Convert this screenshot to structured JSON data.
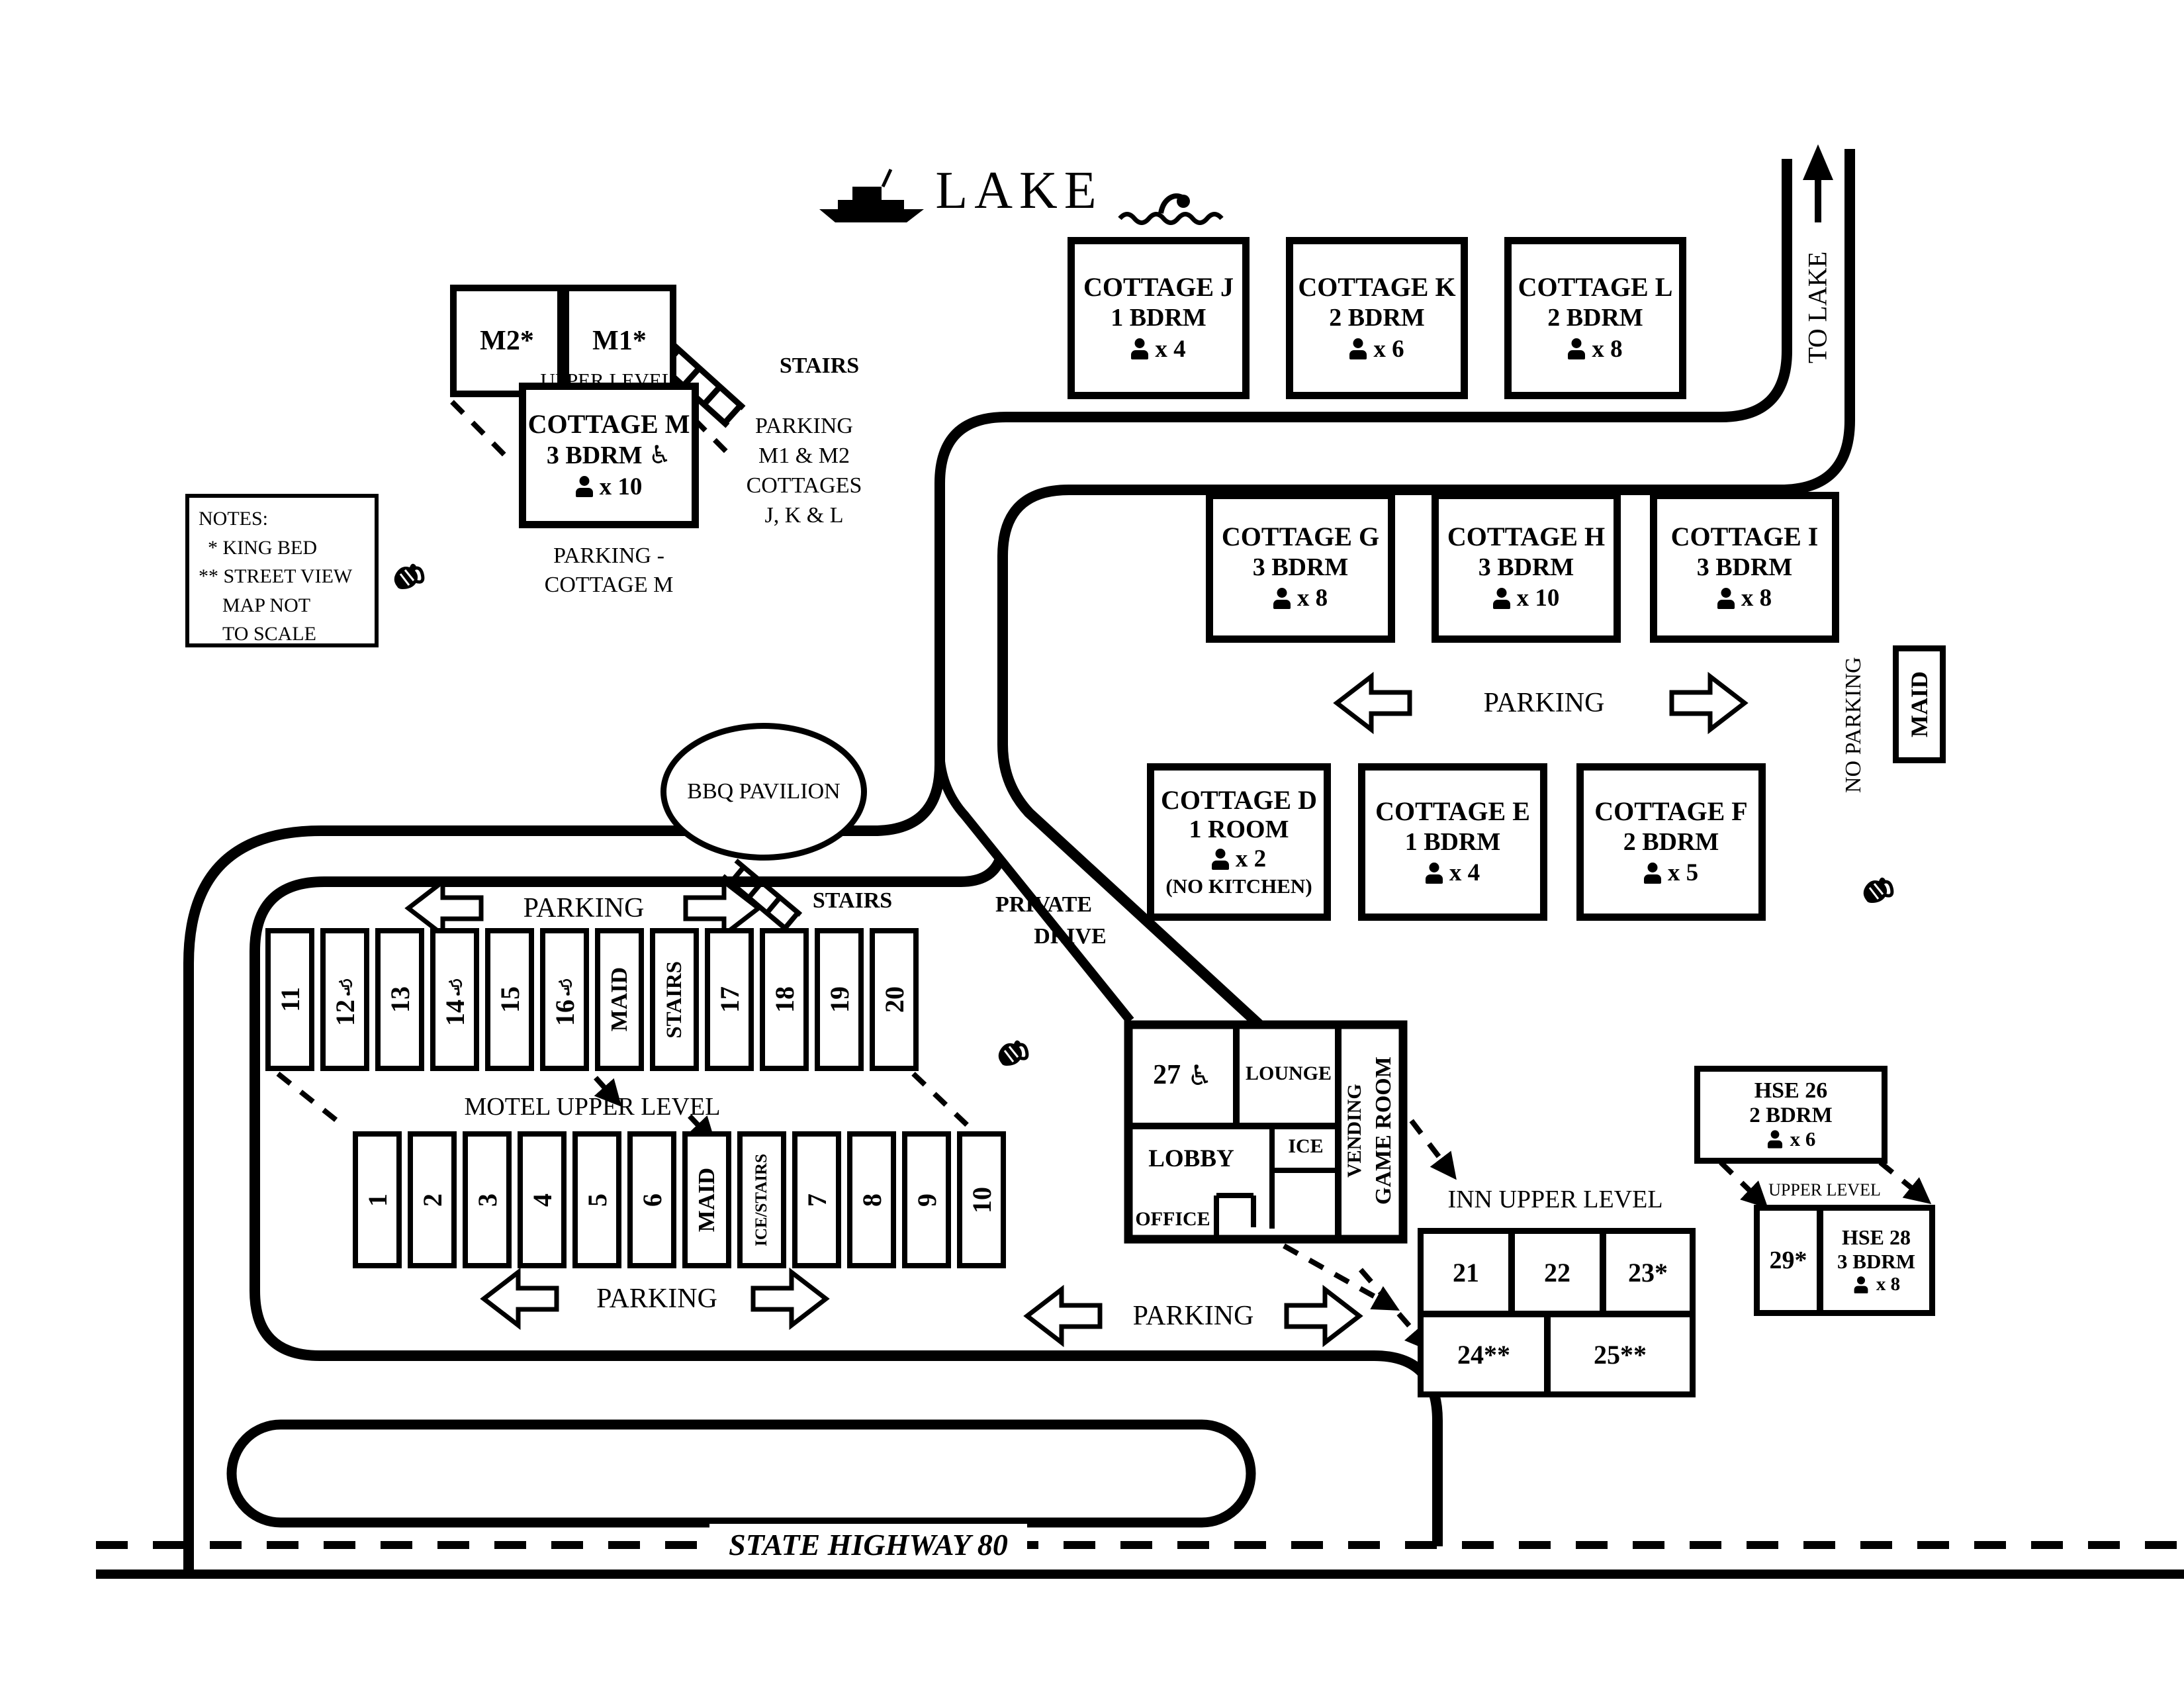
{
  "icons": {
    "wheelchair": "♿"
  },
  "map": {
    "lake_label": "LAKE",
    "to_lake": "TO LAKE",
    "highway": "STATE HIGHWAY 80",
    "bbq": "BBQ PAVILION",
    "parking": "PARKING",
    "stairs": "STAIRS",
    "no_parking": "NO PARKING",
    "maid": "MAID",
    "private_drive_1": "PRIVATE",
    "private_drive_2": "DRIVE",
    "notes": {
      "heading": "NOTES:",
      "line1": "* KING BED",
      "line2": "** STREET VIEW",
      "line3": "MAP NOT",
      "line4": "TO SCALE"
    },
    "m_units": {
      "m2": "M2*",
      "m1": "M1*",
      "upper_level": "UPPER LEVEL",
      "jkl_parking_1": "PARKING",
      "jkl_parking_2": "M1 & M2",
      "jkl_parking_3": "COTTAGES",
      "jkl_parking_4": "J, K & L",
      "m_parking_1": "PARKING -",
      "m_parking_2": "COTTAGE M"
    },
    "cottages": {
      "j": {
        "name": "COTTAGE J",
        "beds": "1 BDRM",
        "occ": "x 4"
      },
      "k": {
        "name": "COTTAGE K",
        "beds": "2 BDRM",
        "occ": "x 6"
      },
      "l": {
        "name": "COTTAGE L",
        "beds": "2 BDRM",
        "occ": "x 8"
      },
      "g": {
        "name": "COTTAGE G",
        "beds": "3 BDRM",
        "occ": "x 8"
      },
      "h": {
        "name": "COTTAGE H",
        "beds": "3 BDRM",
        "occ": "x 10"
      },
      "i": {
        "name": "COTTAGE I",
        "beds": "3 BDRM",
        "occ": "x 8"
      },
      "d": {
        "name": "COTTAGE D",
        "beds": "1 ROOM",
        "occ": "x 2",
        "note": "(NO KITCHEN)"
      },
      "e": {
        "name": "COTTAGE E",
        "beds": "1 BDRM",
        "occ": "x 4"
      },
      "f": {
        "name": "COTTAGE F",
        "beds": "2 BDRM",
        "occ": "x 5"
      },
      "m": {
        "name": "COTTAGE M",
        "beds": "3 BDRM",
        "occ": "x 10"
      }
    },
    "motel": {
      "caption": "MOTEL UPPER LEVEL",
      "upper": [
        "11",
        "12",
        "13",
        "14",
        "15",
        "16",
        "MAID",
        "STAIRS",
        "17",
        "18",
        "19",
        "20"
      ],
      "lower": [
        "1",
        "2",
        "3",
        "4",
        "5",
        "6",
        "MAID",
        "ICE/STAIRS",
        "7",
        "8",
        "9",
        "10"
      ]
    },
    "inn": {
      "caption": "INN UPPER LEVEL",
      "room27": "27",
      "lounge": "LOUNGE",
      "lobby": "LOBBY",
      "office": "OFFICE",
      "ice": "ICE",
      "vending": "VENDING",
      "game_room": "GAME ROOM",
      "r21": "21",
      "r22": "22",
      "r23": "23*",
      "r24": "24**",
      "r25": "25**"
    },
    "houses": {
      "hse26": {
        "name": "HSE 26",
        "beds": "2 BDRM",
        "occ": "x 6"
      },
      "hse28": {
        "name": "HSE 28",
        "beds": "3 BDRM",
        "occ": "x 8"
      },
      "r29": "29*",
      "upper_level": "UPPER LEVEL"
    }
  }
}
